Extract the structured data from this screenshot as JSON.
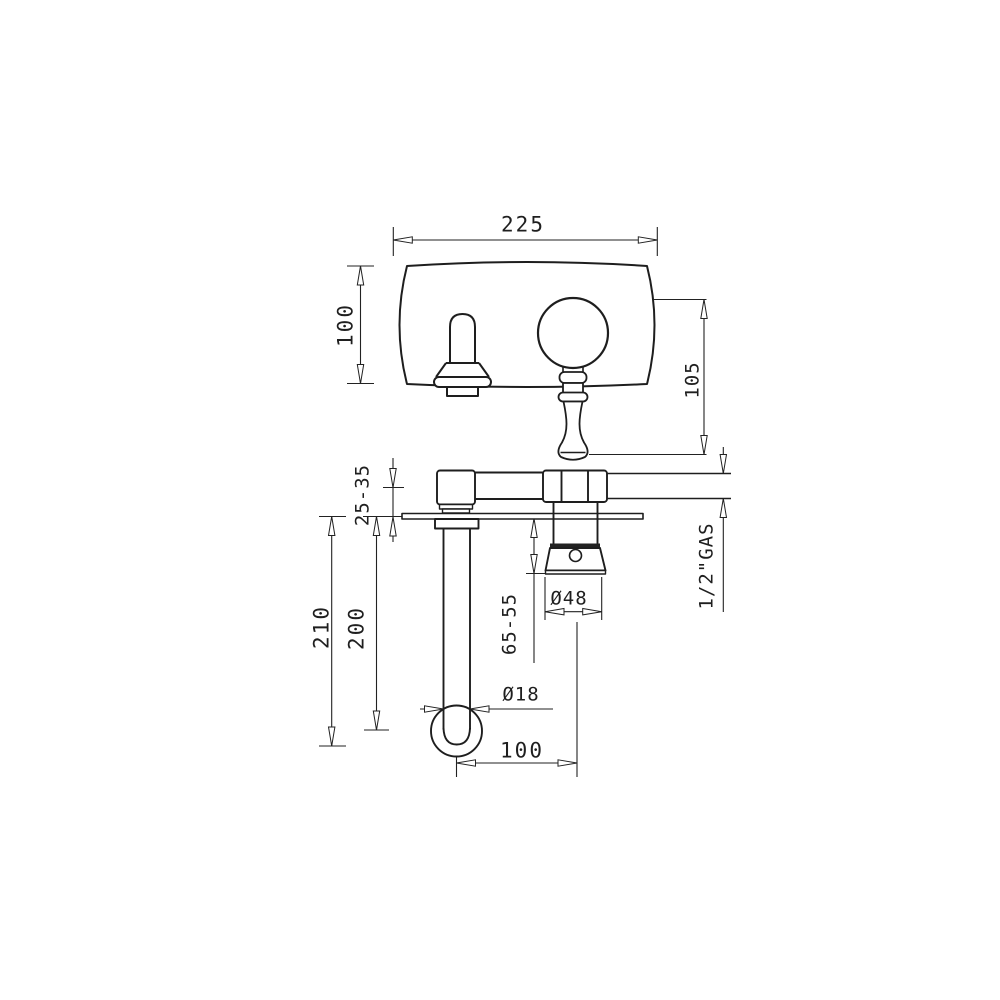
{
  "page": {
    "background": "#ffffff",
    "line_color": "#1f1f1f",
    "description": "Technical installation drawing of a wall-mounted two-hole basin mixer (front view and plan view) with dimensions in millimetres"
  },
  "dimensions": {
    "plate_width": "225",
    "plate_height": "100",
    "handle_length": "105",
    "wall_depth_range": "25-35",
    "spout_drop_max": "210",
    "spout_drop": "200",
    "trim_depth_range": "65-55",
    "escutcheon_diameter": "Ø48",
    "spout_tube_diameter": "Ø18",
    "spout_projection": "100",
    "thread_label": "1/2\"GAS"
  }
}
